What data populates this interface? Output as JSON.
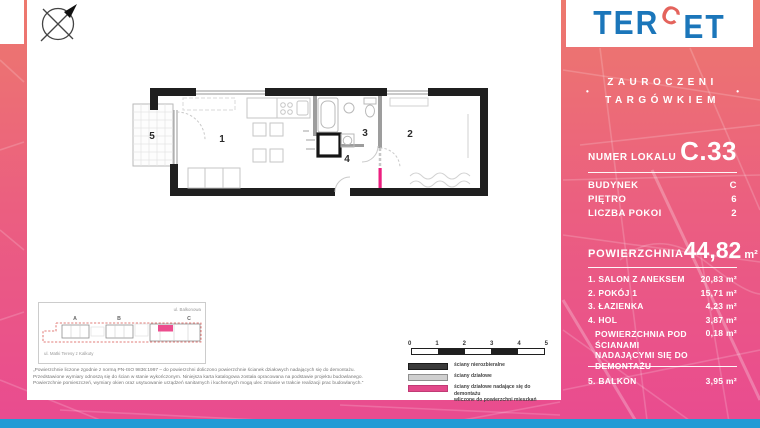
{
  "logo": {
    "part1": "TER",
    "part2": "C",
    "part3": "ET"
  },
  "tagline": {
    "line1": "ZAUROCZENI",
    "line2": "TARGÓWKIEM",
    "dot": "•"
  },
  "unit_number": {
    "label": "NUMER LOKALU",
    "value": "C.33"
  },
  "details": [
    {
      "label": "BUDYNEK",
      "value": "C"
    },
    {
      "label": "PIĘTRO",
      "value": "6"
    },
    {
      "label": "LICZBA POKOI",
      "value": "2"
    }
  ],
  "area": {
    "label": "POWIERZCHNIA",
    "value": "44,82",
    "unit": "m²"
  },
  "rooms": [
    {
      "name": "1. SALON Z ANEKSEM",
      "value": "20,83 m²"
    },
    {
      "name": "2. POKÓJ 1",
      "value": "15,71 m²"
    },
    {
      "name": "3. ŁAZIENKA",
      "value": "4,23 m²"
    },
    {
      "name": "4. HOL",
      "value": "3,87 m²"
    },
    {
      "name": "POWIERZCHNIA POD ŚCIANAMI NADAJĄCYMI SIĘ DO DEMONTAŻU",
      "value": "0,18 m²"
    }
  ],
  "balcony": {
    "name": "5. BALKON",
    "value": "3,95 m²"
  },
  "floor_plan": {
    "room_labels": {
      "r1": "1",
      "r2": "2",
      "r3": "3",
      "r4": "4",
      "r5": "5"
    }
  },
  "site_plan": {
    "street_top": "ul. Balkonowa",
    "street_bottom": "ul. Matki Teresy z Kalkuty",
    "building_a": "A",
    "building_b": "B",
    "building_c": "C"
  },
  "scale_bar": {
    "ticks": [
      "0",
      "1",
      "2",
      "3",
      "4",
      "5"
    ]
  },
  "legend": {
    "item1": "ściany nierozbieralne",
    "item2": "ściany działowe",
    "item3_line1": "ściany działowe nadające się do demontażu",
    "item3_line2": "wliczone do powierzchni mieszkań"
  },
  "disclaimer": [
    "„Powierzchnie liczone zgodnie z normą PN-ISO 9836:1997 – do powierzchni doliczono powierzchnie ścianek działowych nadających się do demontażu.",
    "Przedstawione wymiary odnoszą się do ścian w stanie wykończonym. Niniejsza karta katalogowa została opracowana na podstawie projektu budowlanego.",
    "Powierzchnie pomieszczeń, wymiary okien oraz usytuowanie urządzeń sanitarnych i kuchennych mogą ulec zmianie w trakcie realizacji prac budowlanych.”"
  ],
  "colors": {
    "pink_top": "#ED796D",
    "pink_bottom": "#E94B90",
    "accent_magenta": "#EC4D8E",
    "wall_demolishable": "#EC1F7F",
    "logo_blue": "#1B76BA",
    "logo_red": "#E4635C",
    "bottom_bar_blue": "#229BD5"
  }
}
